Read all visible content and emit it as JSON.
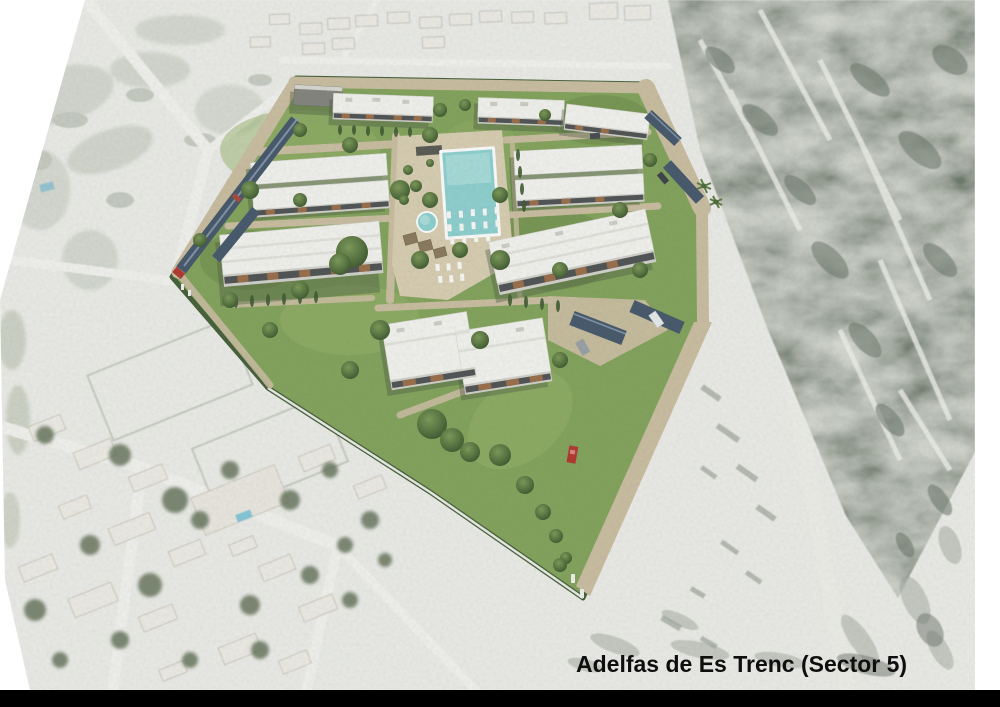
{
  "caption": {
    "text": "Adelfas de Es Trenc (Sector 5)"
  },
  "colors": {
    "page_bg": "#ffffff",
    "footer_bar": "#000000",
    "caption_text": "#0e0e0e",
    "photo_base": "#edeeea",
    "grass": "#83a45c",
    "hedge": "#46603a",
    "road_tan": "#cbbfa2",
    "deck": "#d9cfb3",
    "pool": "#8ed2d1",
    "pool_light": "#b2e2e0",
    "roof_white": "#f4f4f0",
    "facade": "#d3d3cd",
    "window_band": "#4f5355",
    "wood": "#9b6e4a",
    "carport": "#46586c",
    "car_red": "#b23730",
    "bg_road": "#f4f4f1",
    "bg_house": "#efede7",
    "bg_tree": "#5f6e54",
    "scrub": "#6e7a6c"
  }
}
